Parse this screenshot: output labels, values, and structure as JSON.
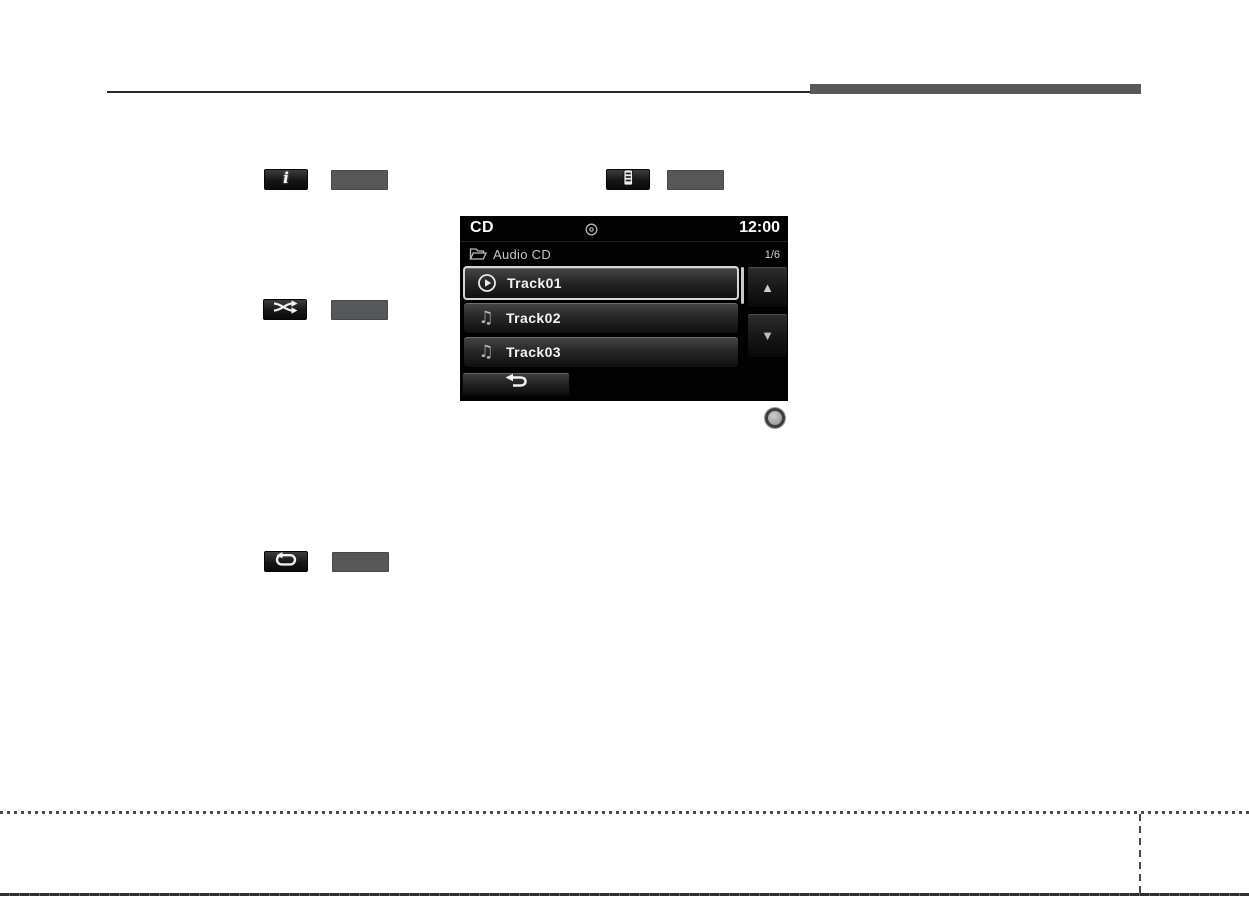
{
  "page": {
    "bg": "#ffffff"
  },
  "header": {
    "rule_color": "#2b2b2b",
    "tab_color": "#58595b"
  },
  "figures": {
    "info_button": {
      "icon": "info-icon",
      "glyph": "i"
    },
    "list_button": {
      "icon": "track-list-icon"
    },
    "shuffle_button": {
      "icon": "shuffle-icon"
    },
    "repeat_button": {
      "icon": "repeat-icon"
    },
    "knob": {
      "icon": "tune-knob"
    }
  },
  "cd": {
    "statusbar": {
      "source": "CD",
      "clock": "12:00",
      "icon": "disc-icon"
    },
    "path_row": {
      "icon": "folder-icon",
      "label": "Audio CD",
      "position": "1/6"
    },
    "tracks": [
      {
        "title": "Track01",
        "icon": "play-icon",
        "selected": true
      },
      {
        "title": "Track02",
        "icon": "music-note-icon",
        "icon_glyph": "♫",
        "selected": false
      },
      {
        "title": "Track03",
        "icon": "music-note-icon",
        "icon_glyph": "♫",
        "selected": false
      }
    ],
    "scrollbar": {
      "up_glyph": "▲",
      "down_glyph": "▼"
    },
    "colors": {
      "screen_bg": "#000000",
      "selected_border": "#d6d6d6",
      "row_text": "#f2f2f2",
      "muted_text": "#c4c4c4"
    }
  }
}
